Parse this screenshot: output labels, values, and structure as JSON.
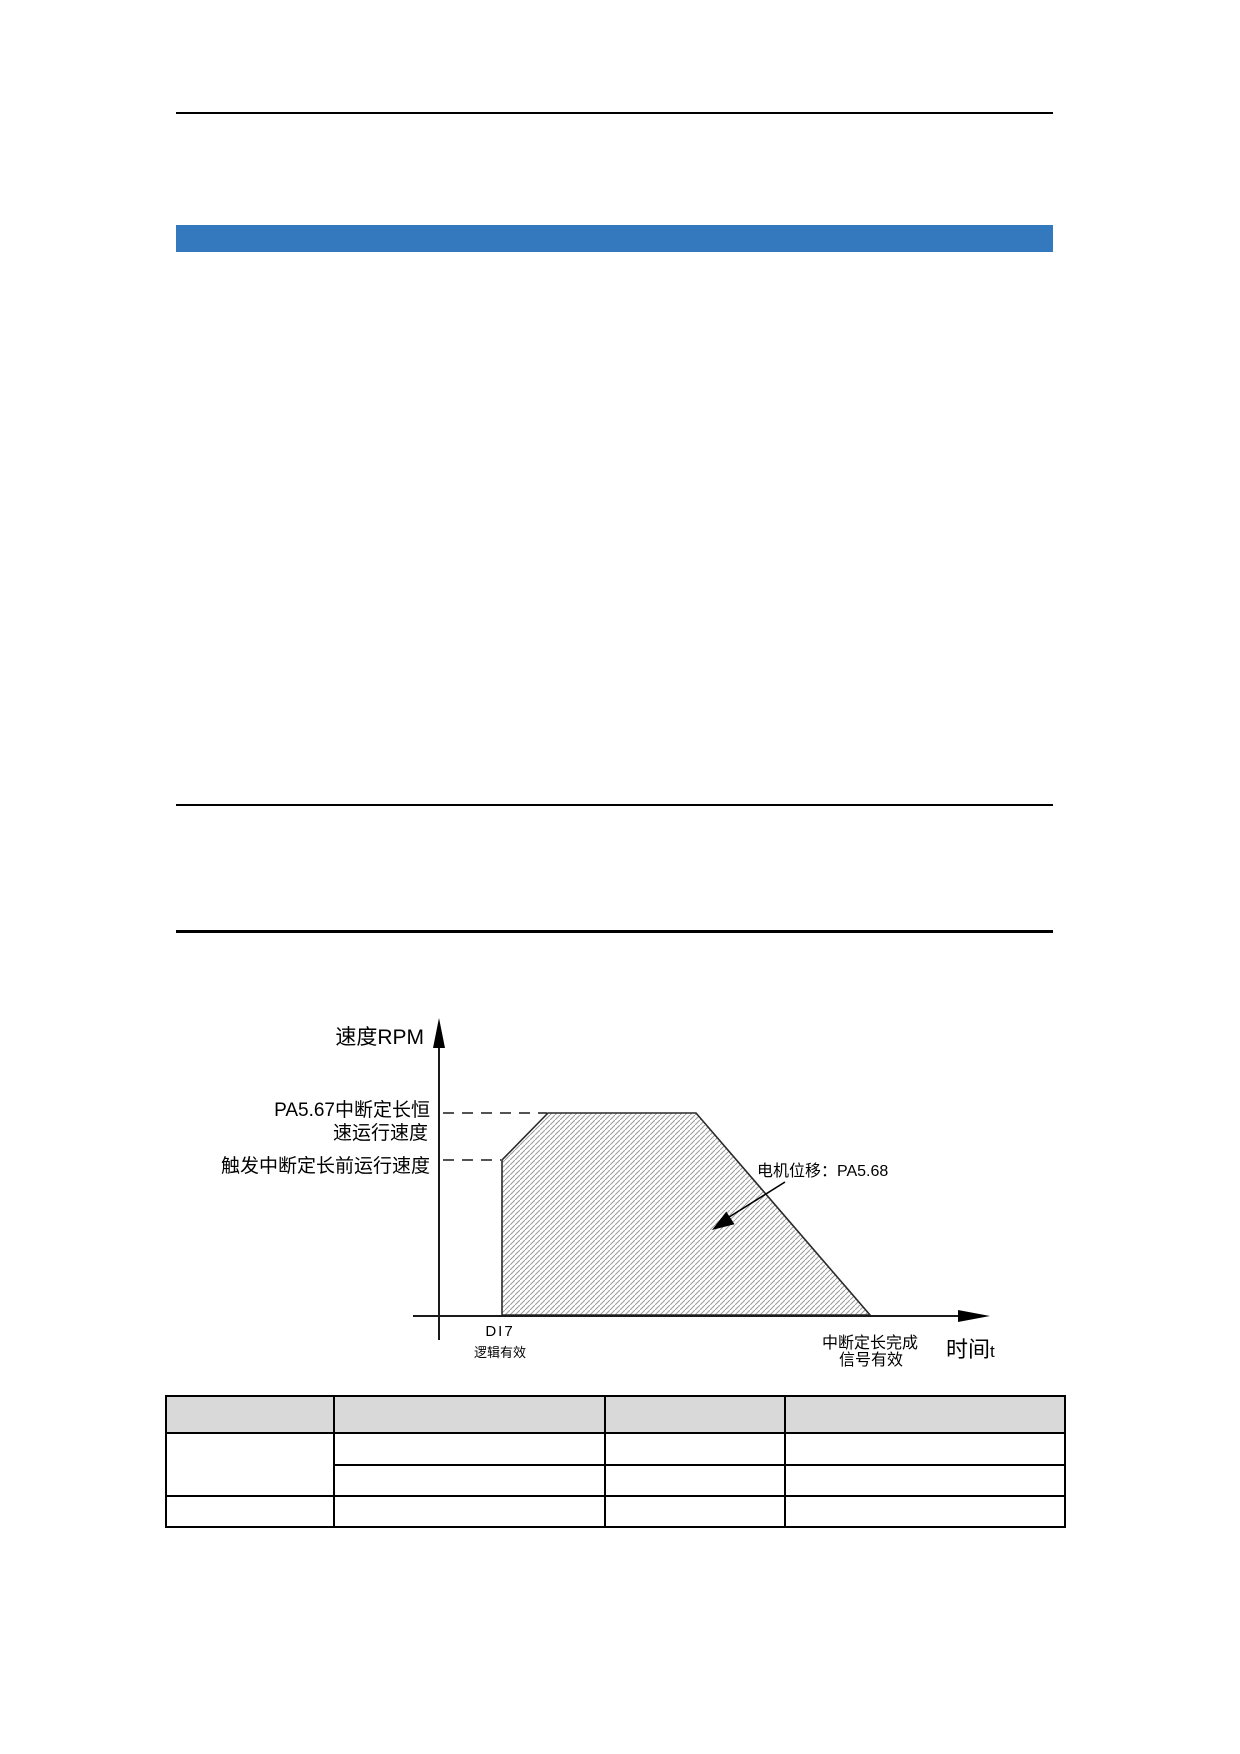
{
  "page": {
    "background": "#ffffff"
  },
  "section_bar": {
    "color": "#3479BD",
    "label": ""
  },
  "diagram": {
    "y_axis_label": "速度RPM",
    "const_speed_label_line1": "PA5.67中断定长恒",
    "const_speed_label_line2": "速运行速度",
    "trigger_speed_label": "触发中断定长前运行速度",
    "motor_displacement_label": "电机位移：PA5.68",
    "di7_label": "DI7",
    "di7_sub_label": "逻辑有效",
    "complete_label_line1": "中断定长完成",
    "complete_label_line2": "信号有效",
    "x_axis_label_cjk": "时间",
    "x_axis_label_suffix": "t",
    "hatch_line_color": "#9a9a9a",
    "outline_color": "#2a2a2a"
  },
  "table": {
    "header_bg": "#d9d9d9",
    "headers": [
      "",
      "",
      "",
      ""
    ],
    "row1": [
      "",
      "",
      "",
      ""
    ],
    "row2": [
      "",
      "",
      ""
    ],
    "row3": [
      "",
      "",
      "",
      ""
    ]
  }
}
